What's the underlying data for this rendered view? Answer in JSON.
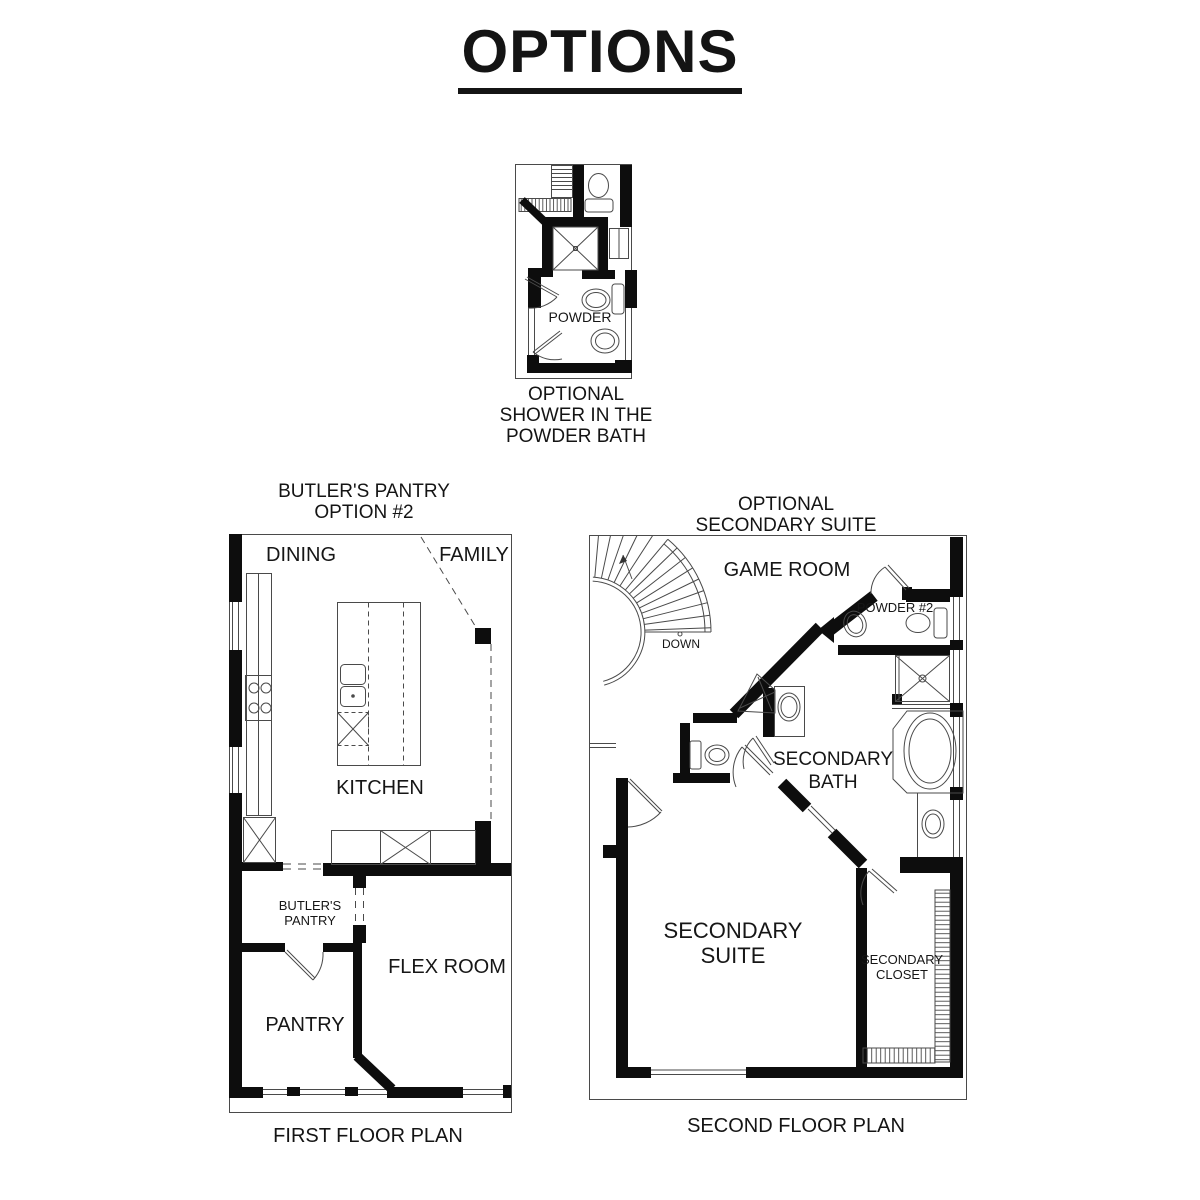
{
  "page_title": "OPTIONS",
  "powder_option": {
    "caption": [
      "OPTIONAL",
      "SHOWER IN THE",
      "POWDER BATH"
    ],
    "room_labels": {
      "powder": "POWDER"
    }
  },
  "first_floor": {
    "header": [
      "BUTLER'S PANTRY",
      "OPTION #2"
    ],
    "caption": "FIRST FLOOR PLAN",
    "room_labels": {
      "dining": "DINING",
      "family": "FAMILY",
      "kitchen": "KITCHEN",
      "butlers_pantry": [
        "BUTLER'S",
        "PANTRY"
      ],
      "flex_room": "FLEX ROOM",
      "pantry": "PANTRY"
    }
  },
  "second_floor": {
    "header": [
      "OPTIONAL",
      "SECONDARY SUITE"
    ],
    "caption": "SECOND FLOOR PLAN",
    "room_labels": {
      "game_room": "GAME ROOM",
      "stair": "DOWN",
      "powder_2": "POWDER #2",
      "secondary_bath": [
        "SECONDARY",
        "BATH"
      ],
      "secondary_suite": [
        "SECONDARY",
        "SUITE"
      ],
      "secondary_closet": [
        "SECONDARY",
        "CLOSET"
      ]
    }
  },
  "colors": {
    "ink": "#141414",
    "wall": "#0d0d0d",
    "thin_line": "#4a4a4a",
    "background": "#ffffff"
  }
}
